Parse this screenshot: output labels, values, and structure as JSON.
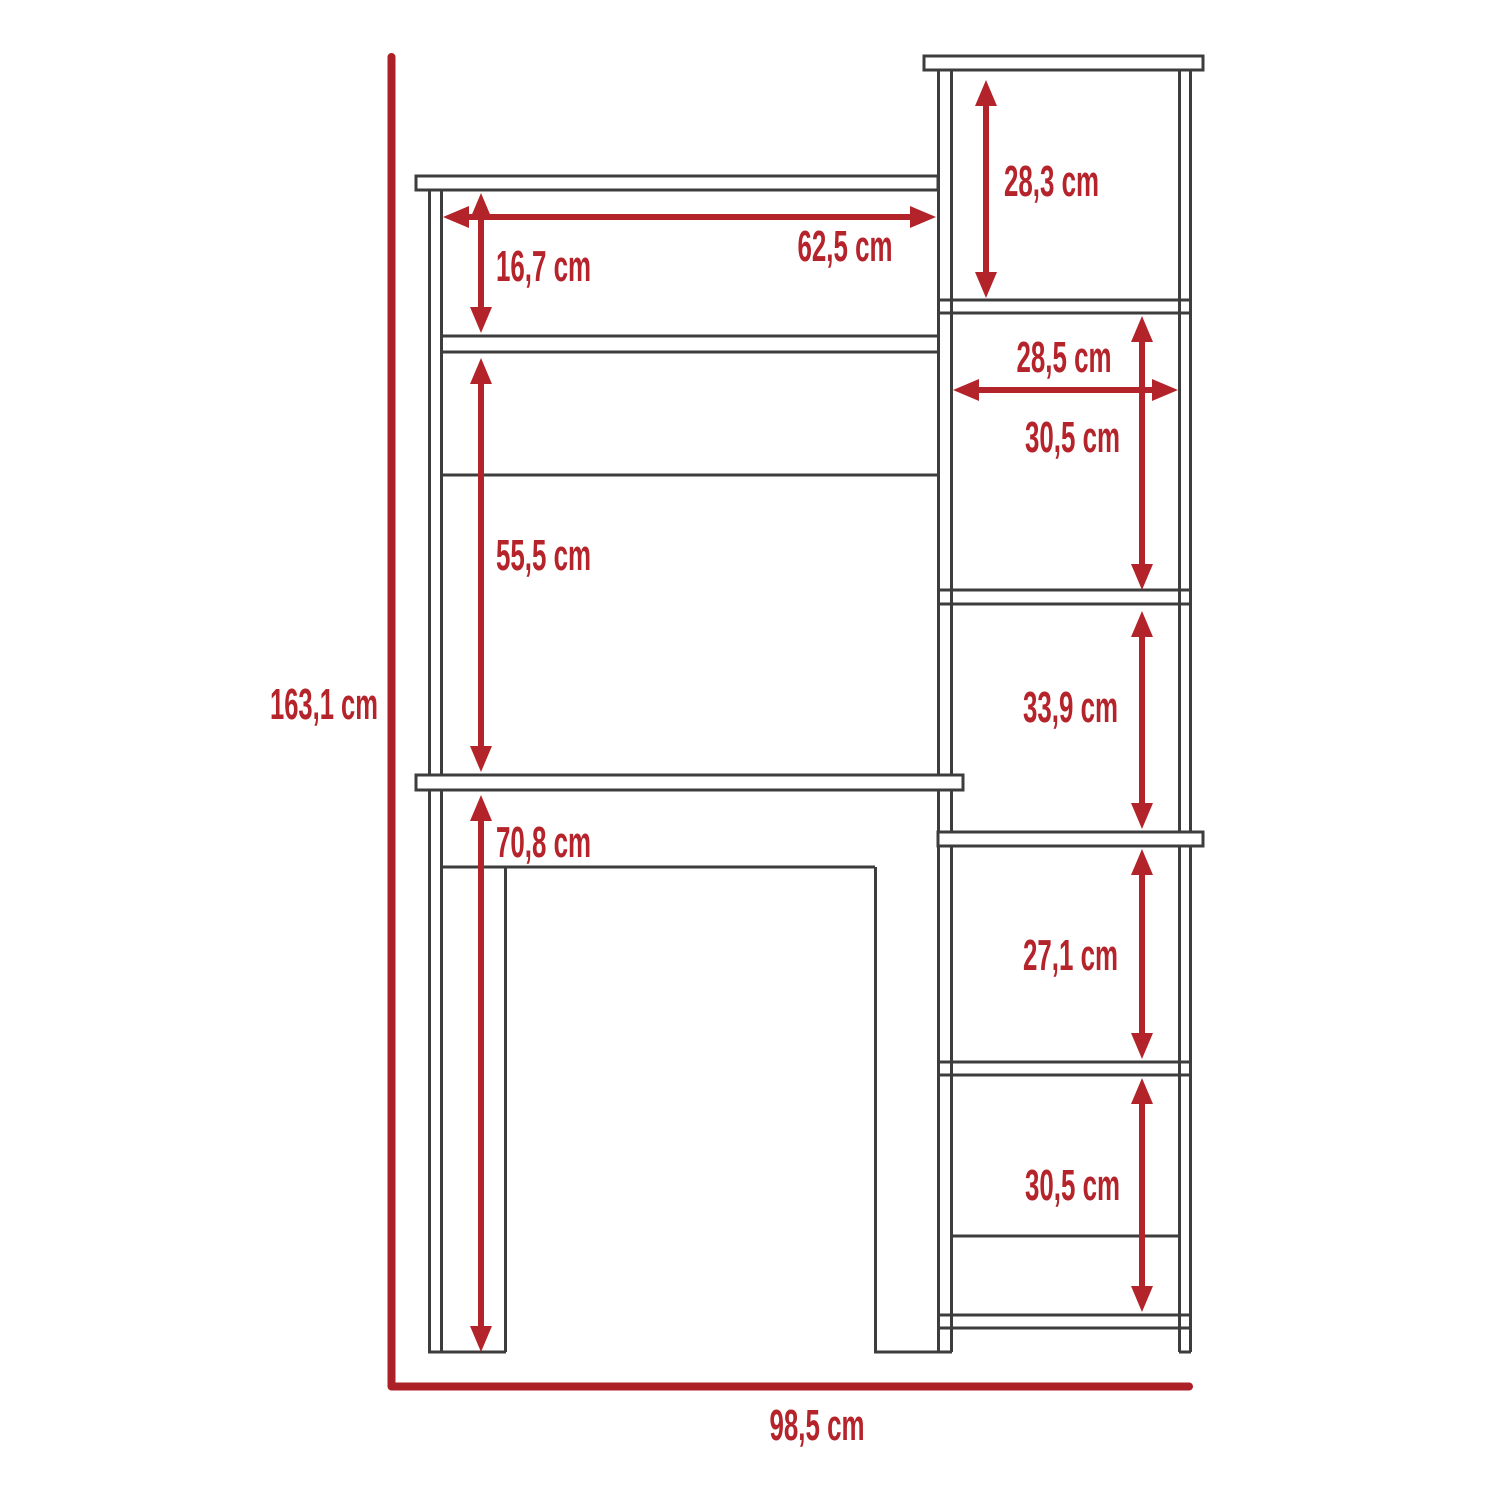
{
  "diagram": {
    "kind": "furniture-dimension-drawing",
    "subject": "desk-with-hutch-and-side-bookcase",
    "unit": "cm",
    "colors": {
      "dimension_red": "#b2242a",
      "label_red": "#b5232b",
      "outline_gray": "#3d3d3d",
      "background": "#ffffff"
    },
    "labels": {
      "overall_height": "163,1 cm",
      "overall_width": "98,5 cm",
      "hutch_opening_width": "62,5 cm",
      "hutch_top_shelf_height": "16,7 cm",
      "hutch_opening_height": "55,5 cm",
      "desk_underside_height": "70,8 cm",
      "bookcase_top_shelf_height": "28,3 cm",
      "bookcase_shelf_width": "28,5 cm",
      "bookcase_shelf2_height": "30,5 cm",
      "bookcase_shelf3_height": "33,9 cm",
      "bookcase_shelf4_height": "27,1 cm",
      "bookcase_shelf5_height": "30,5 cm"
    }
  }
}
